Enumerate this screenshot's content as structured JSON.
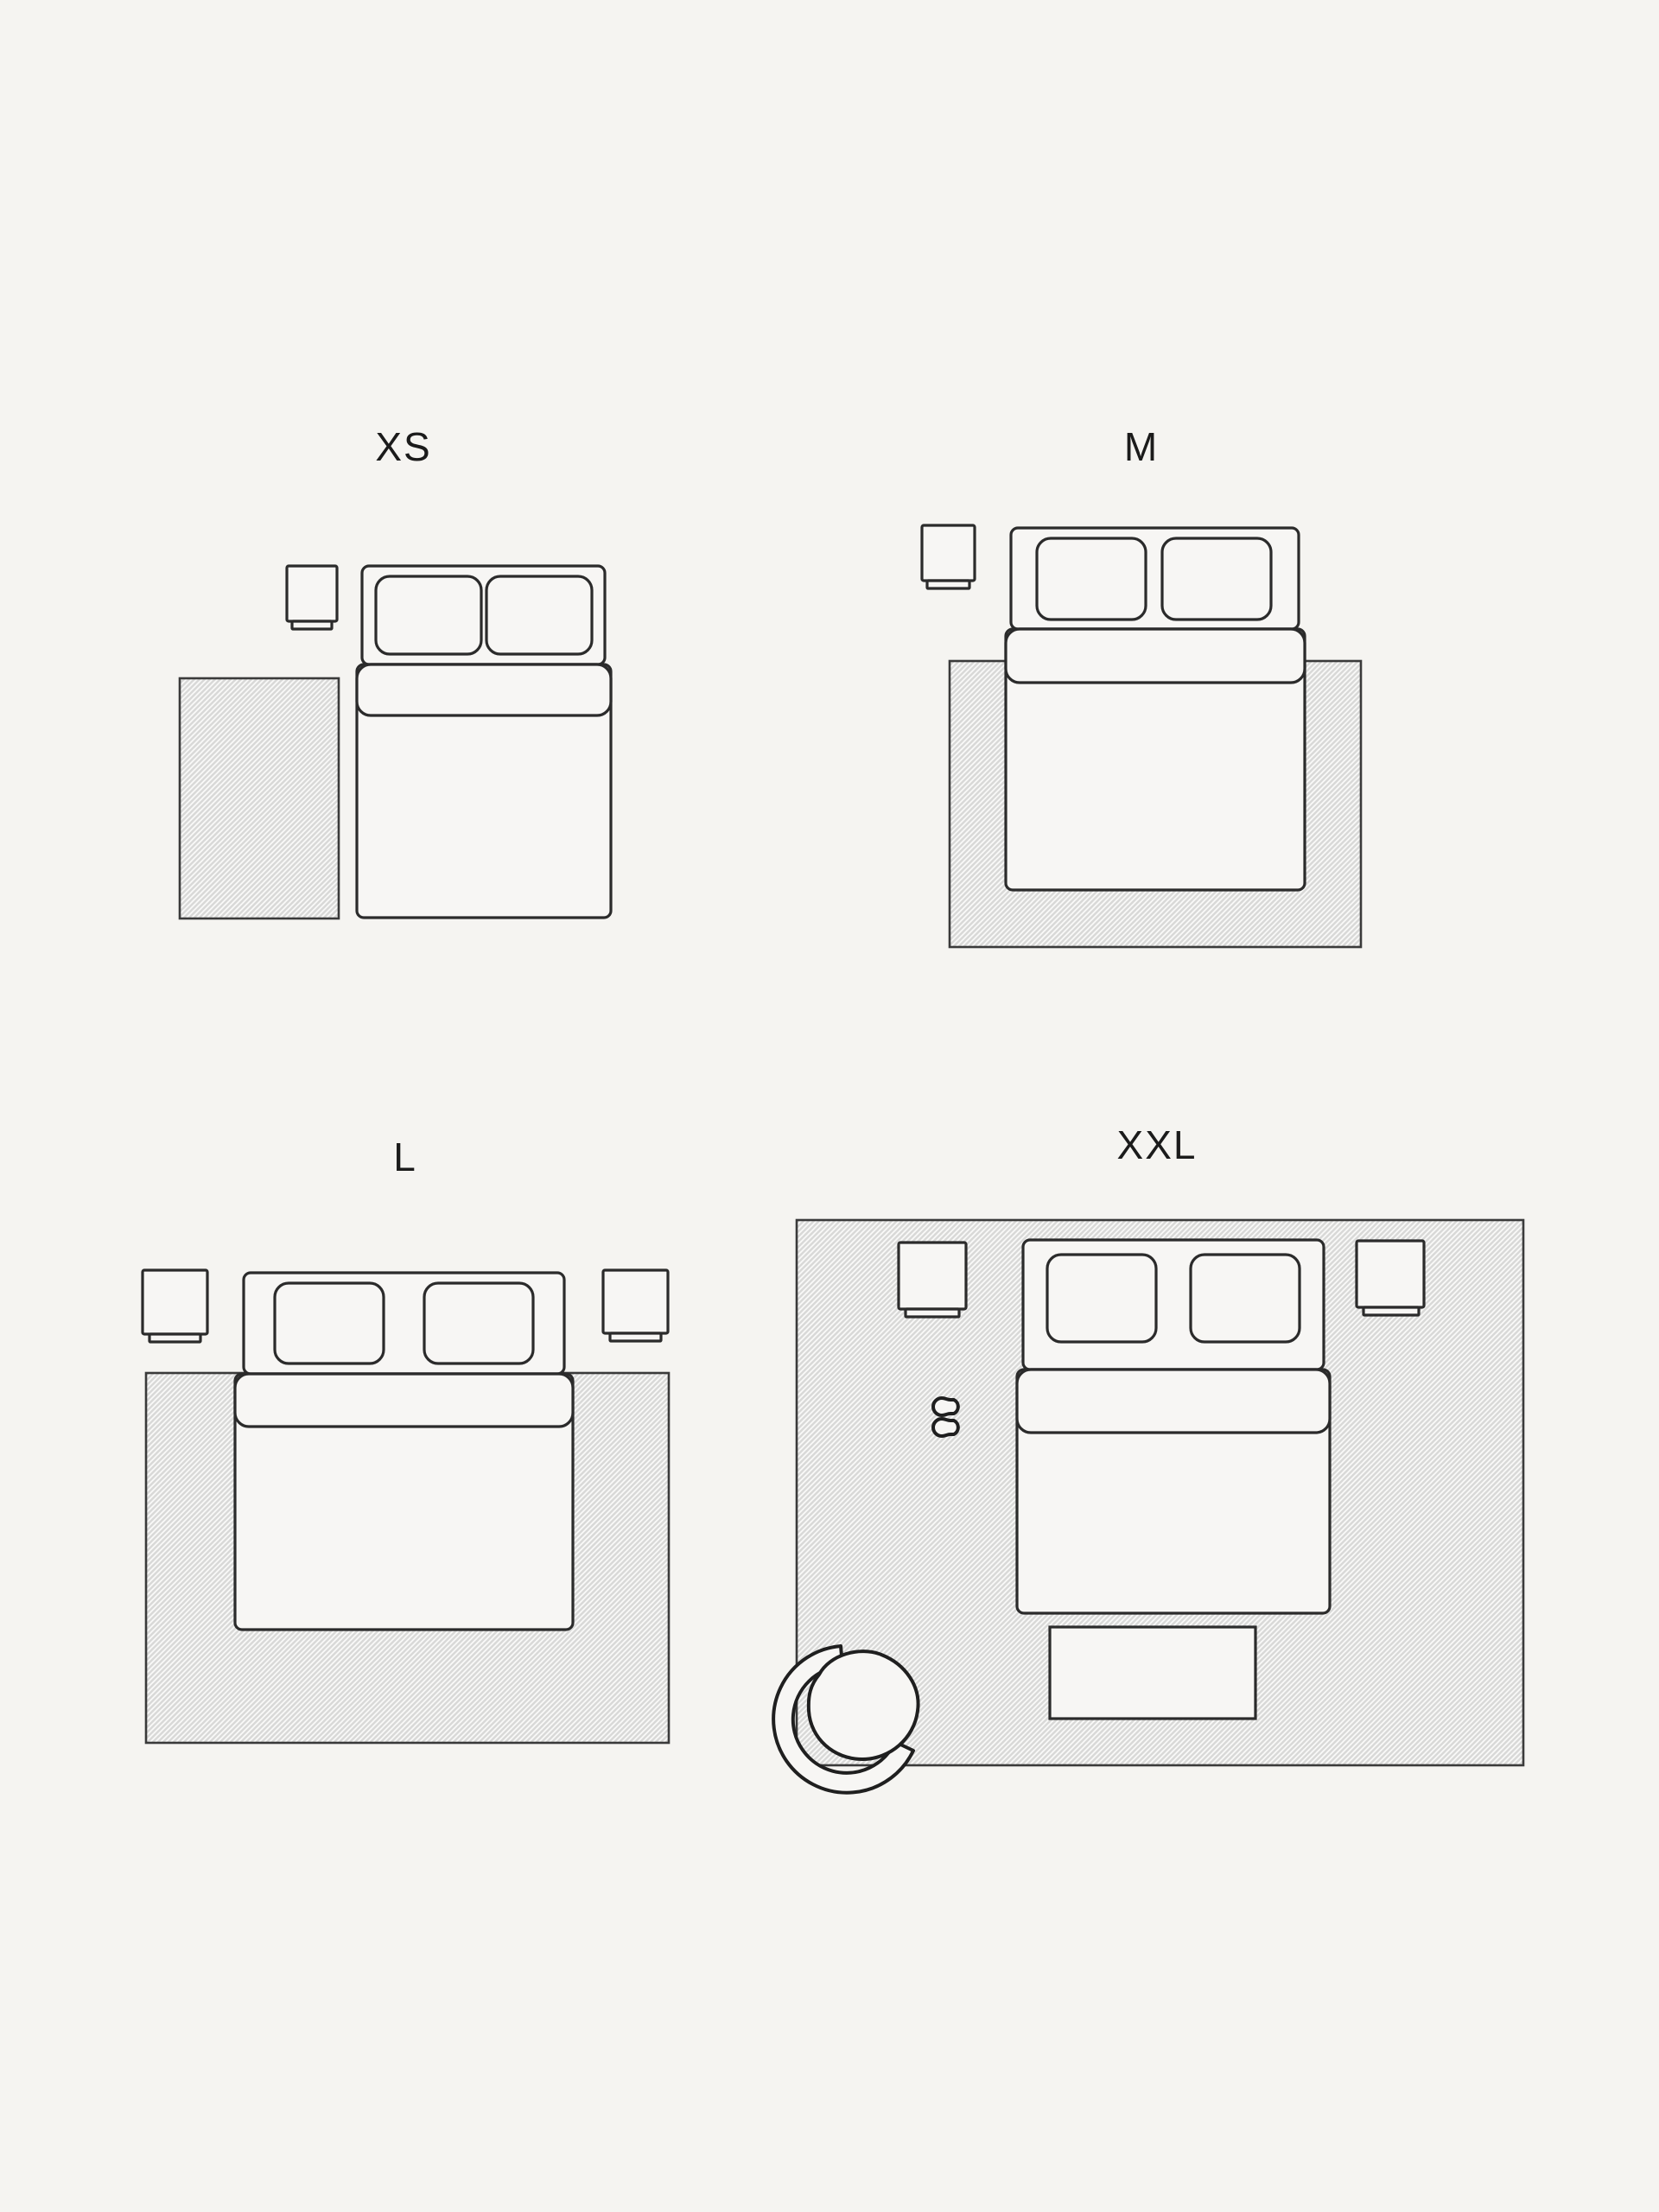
{
  "page": {
    "background_color": "#f5f4f1",
    "description_labels_only": true
  },
  "palette": {
    "outline": "#2b2b2b",
    "label_color": "#1b1b1b",
    "furniture_fill": "#f7f6f4",
    "rug_fill": "#d9d9d8",
    "rug_hatch_line": "#fafaf9",
    "rug_border": "#3a3a3a"
  },
  "icons": {
    "bed": "double-bed-top-view",
    "pillow": "pillow-top-view",
    "nightstand": "nightstand-top-view",
    "rug": "hatched-rug-area",
    "slippers": "slippers-top-view",
    "armchair": "armchair-top-view",
    "bench": "bed-end-bench-top-view"
  },
  "size_guide": {
    "sizes": [
      {
        "id": "xs",
        "label": "XS"
      },
      {
        "id": "m",
        "label": "M"
      },
      {
        "id": "l",
        "label": "L"
      },
      {
        "id": "xxl",
        "label": "XXL"
      }
    ]
  }
}
